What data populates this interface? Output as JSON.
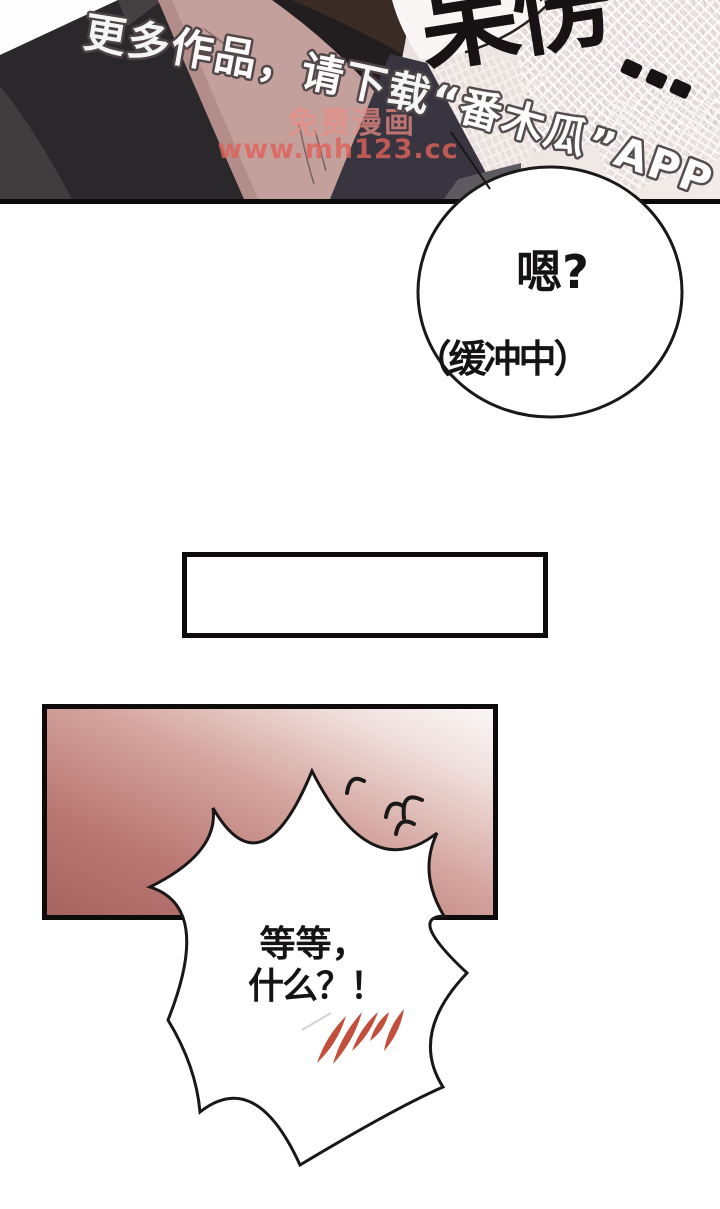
{
  "page": {
    "type": "comic-page",
    "width": 720,
    "height": 1209,
    "background": "#ffffff"
  },
  "dialogue": {
    "round_bubble": {
      "line1": "嗯?",
      "line2": "（缓冲中）"
    },
    "burst_bubble": {
      "line1": "等等，",
      "line2": "什么？！"
    },
    "sfx": {
      "text": "呆愣",
      "dots": "…"
    }
  },
  "watermarks": {
    "app_promo": "更多作品，请下载“番木瓜”APP。",
    "site_name": "免费漫画",
    "site_url": "www.mh123.cc"
  },
  "caption_box": {
    "text": ""
  },
  "colors": {
    "ink": "#161314",
    "panel_border": "#0d0b0c",
    "pink_panel_dark": "#a66360",
    "pink_panel_light": "#fbf7f6",
    "slash_red": "#c14f3c",
    "watermark_pink": "#e0625a",
    "watermark_outline_white": "#ffffff",
    "skin": "#c4a09d",
    "jacket": "#2b282b"
  }
}
